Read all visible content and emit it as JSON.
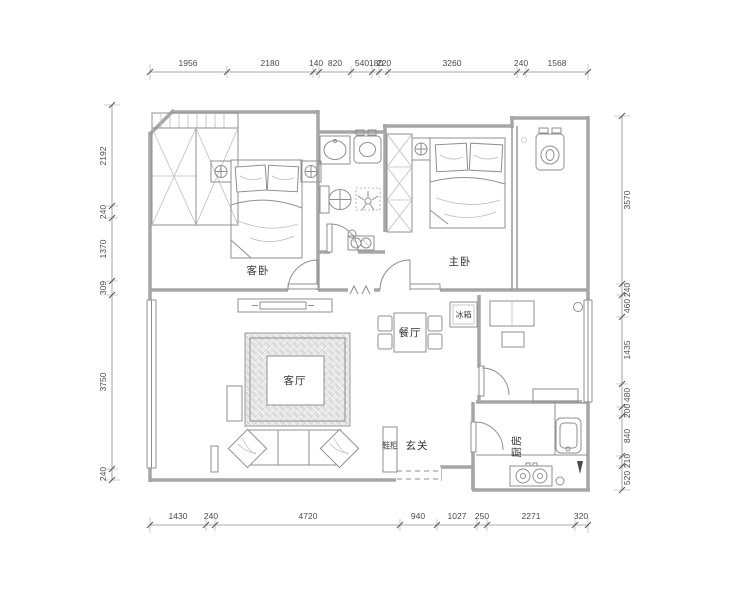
{
  "plan": {
    "rooms": {
      "guest_bedroom": "客卧",
      "master_bedroom": "主卧",
      "dining": "餐厅",
      "living": "客厅",
      "foyer": "玄关",
      "kitchen": "厨房"
    },
    "fixtures": {
      "fridge": "冰箱",
      "shoe_cabinet": "鞋柜"
    },
    "dimensions": {
      "top": [
        "1956",
        "2180",
        "140",
        "820",
        "540",
        "180",
        "220",
        "3260",
        "240",
        "1568"
      ],
      "bottom": [
        "1430",
        "240",
        "4720",
        "940",
        "1027",
        "250",
        "2271",
        "320"
      ],
      "left": [
        "2192",
        "240",
        "1370",
        "309",
        "3750",
        "240"
      ],
      "right": [
        "3570",
        "240",
        "460",
        "1435",
        "480",
        "200",
        "840",
        "210",
        "520"
      ]
    },
    "colors": {
      "wall": "#a6a6a6",
      "furniture_line": "#8f8f8f",
      "dimension_text": "#4a4a4a",
      "label_text": "#333333",
      "background": "#ffffff"
    }
  }
}
